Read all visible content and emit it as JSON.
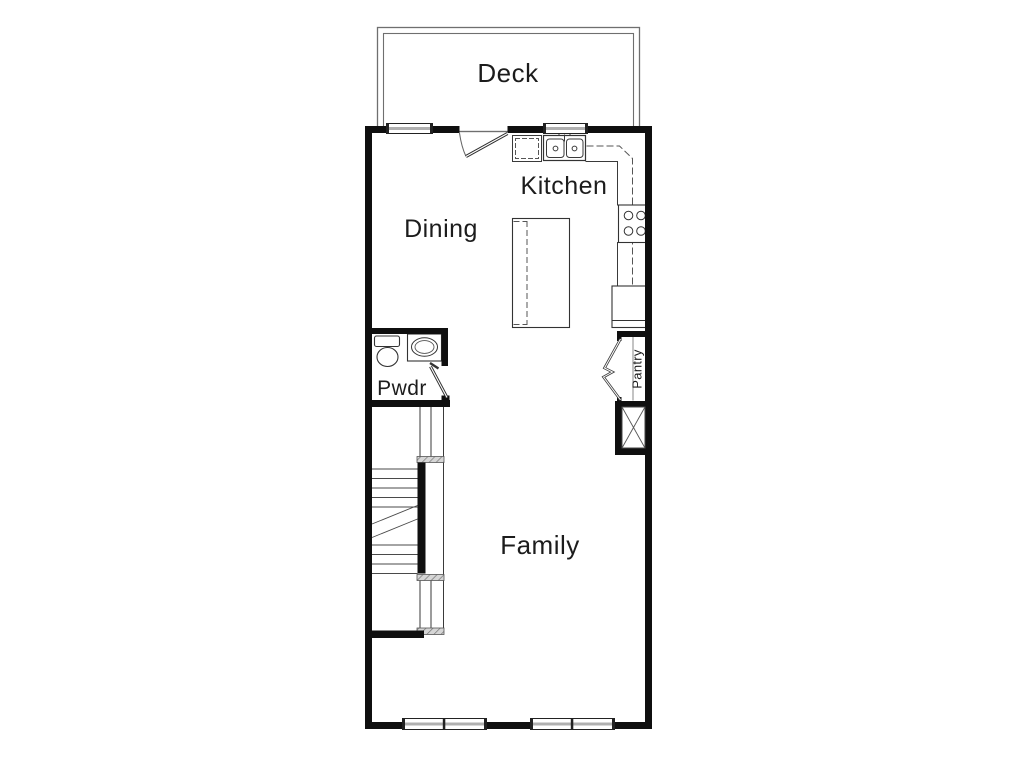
{
  "floorplan": {
    "rooms": {
      "deck": {
        "label": "Deck"
      },
      "kitchen": {
        "label": "Kitchen"
      },
      "dining": {
        "label": "Dining"
      },
      "powder": {
        "label": "Pwdr"
      },
      "pantry": {
        "label": "Pantry"
      },
      "family": {
        "label": "Family"
      }
    },
    "icons": {
      "entry_door": "door-swing-icon",
      "powder_door": "door-swing-icon",
      "pantry_door": "bifold-door-icon",
      "kitchen_sink": "double-basin-sink-icon",
      "dishwasher": "dishwasher-icon",
      "cooktop": "cooktop-4-burner-icon",
      "refrigerator": "refrigerator-icon",
      "island": "kitchen-island-icon",
      "toilet": "toilet-icon",
      "vanity": "vanity-sink-icon",
      "stairs": "staircase-icon",
      "chase": "x-chase-icon",
      "window": "window-icon"
    },
    "colors": {
      "background": "#ffffff",
      "wall": "#0f0f0f",
      "line": "#3a3a3a",
      "dashed_line": "#555555",
      "window_band": "#b0b0b0",
      "hatch": "#bdbdbd",
      "text": "#1c1c1c"
    }
  }
}
